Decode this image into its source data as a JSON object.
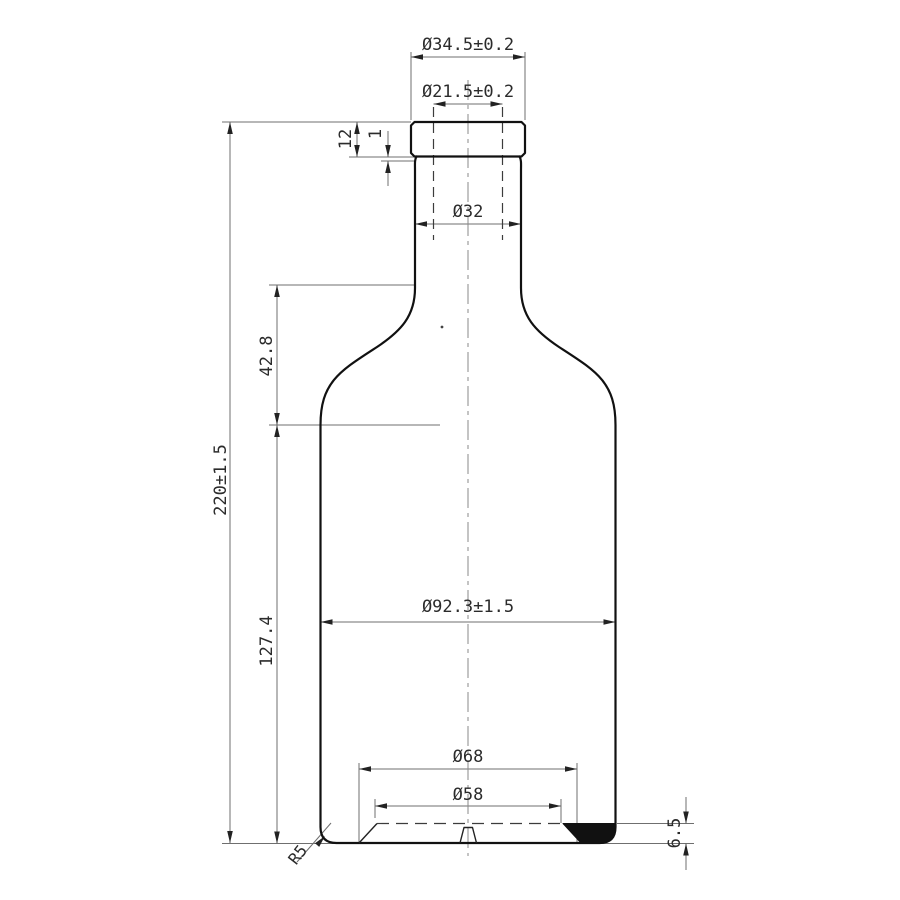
{
  "drawing": {
    "kind": "bottle-engineering-drawing",
    "colors": {
      "background": "#ffffff",
      "outline": "#111111",
      "dimension_lines": "#6f6f6f",
      "text": "#2b2b2b"
    },
    "dimensions": {
      "mouth_outer_diameter": "Ø34.5±0.2",
      "mouth_inner_diameter": "Ø21.5±0.2",
      "finish_height": "12",
      "finish_step": "1",
      "neck_diameter": "Ø32",
      "shoulder_height": "42.8",
      "overall_height": "220±1.5",
      "body_height": "127.4",
      "body_diameter": "Ø92.3±1.5",
      "base_outer_diameter": "Ø68",
      "base_inner_diameter": "Ø58",
      "base_height": "6.5",
      "base_corner_radius": "R5"
    }
  }
}
